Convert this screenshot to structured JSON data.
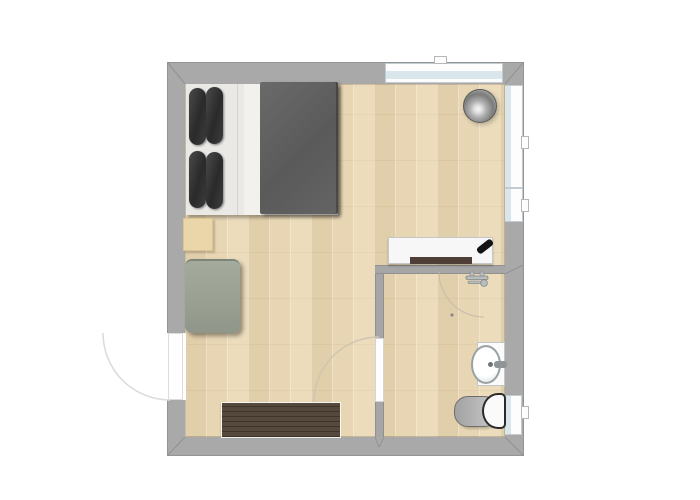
{
  "meta": {
    "title": "Studio apartment floor plan",
    "view": "top-down 2D rendered floor plan",
    "visible_text": "none"
  },
  "palette": {
    "background": "#ffffff",
    "wall_gray": "#a9a9a9",
    "floor_wood": "#e9d9b8",
    "window_glass": "#d9e7ed",
    "window_frame": "#fdfdfd",
    "duvet_gray": "#5f5f5f",
    "pillow_charcoal": "#303030",
    "mattress_white": "#eae9e5",
    "ottoman_sage": "#99a091",
    "nightstand_wood": "#ead6a8",
    "sideboard_walnut": "#4e4134",
    "console_white": "#f7f7f7",
    "console_base_brown": "#4e4036",
    "lamp_silver": "#8f8f8f",
    "toilet_bowl_gray": "#b5b5b5",
    "door_leaf": "#fefefe",
    "swing_arc": "#d9d9d9"
  },
  "rooms": [
    {
      "id": "bedroom",
      "name": "Bedroom / living area",
      "floor": "light wood planks"
    },
    {
      "id": "bathroom",
      "name": "Bathroom",
      "floor": "light wood planks"
    }
  ],
  "furniture": [
    {
      "id": "double-bed",
      "room": "bedroom",
      "parts": [
        "white mattress",
        "four charcoal pillows",
        "dark gray duvet"
      ]
    },
    {
      "id": "nightstand",
      "room": "bedroom",
      "finish": "light wood"
    },
    {
      "id": "ottoman",
      "room": "bedroom",
      "finish": "sage gray upholstery"
    },
    {
      "id": "sideboard",
      "room": "bedroom",
      "finish": "dark walnut"
    },
    {
      "id": "media-console",
      "room": "bedroom",
      "parts": [
        "white top",
        "dark base",
        "black remote"
      ]
    },
    {
      "id": "floor-lamp",
      "room": "bedroom",
      "finish": "brushed silver"
    }
  ],
  "fixtures": [
    {
      "id": "wash-basin",
      "room": "bathroom",
      "parts": [
        "white vanity",
        "oval basin",
        "wall faucet"
      ]
    },
    {
      "id": "toilet",
      "room": "bathroom",
      "parts": [
        "gray bowl",
        "white lid and tank"
      ]
    },
    {
      "id": "mixer-tap-icon",
      "room": "bathroom"
    }
  ],
  "doors": [
    {
      "id": "entrance-door",
      "wall": "left",
      "swing": "outward quarter arc"
    },
    {
      "id": "bathroom-door",
      "wall": "interior vertical",
      "swing": "into bedroom quarter arc"
    },
    {
      "id": "bathroom-swing-arc",
      "wall": "bathroom top",
      "swing": "faint quarter arc"
    }
  ],
  "windows": [
    {
      "id": "top-window",
      "wall": "top",
      "handles": 1
    },
    {
      "id": "right-window-upper",
      "wall": "right",
      "sashes": 2,
      "handles": 2
    },
    {
      "id": "bathroom-window",
      "wall": "right",
      "handles": 1
    }
  ]
}
